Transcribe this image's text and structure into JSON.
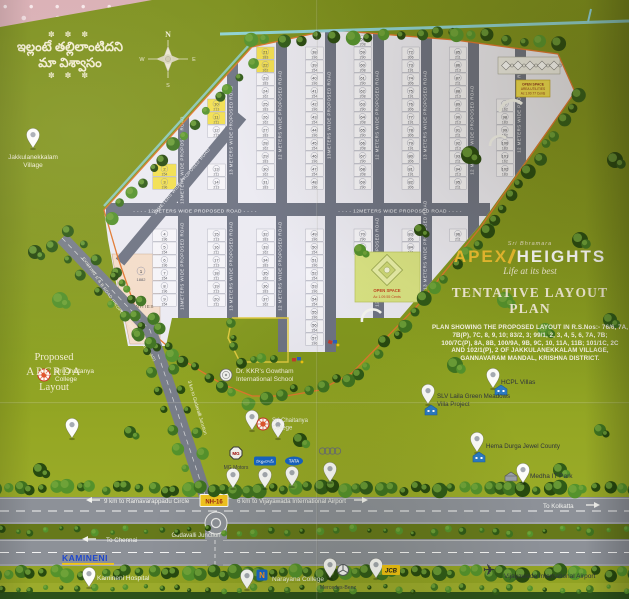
{
  "slogan": {
    "ornament": "✽ ✽ ✽",
    "line1": "ఇల్లంటే తల్లిలాంటిదని",
    "line2": "మా విశ్వాసం"
  },
  "village": {
    "label_line1": "Jakkulanekkalam",
    "label_line2": "Village"
  },
  "branding": {
    "pre_title": "Sri Bhramara",
    "brand_accent": "APEX",
    "brand_rest": "HEIGHTS",
    "tagline": "Life at its best",
    "plan_title": "TENTATIVE LAYOUT PLAN",
    "description_lines": [
      "PLAN SHOWING THE PROPOSED LAYOUT IN R.S.Nos:- 76/6, 7A,",
      "7B(P), 7C, 8, 9, 10; 83/2, 3; 99/1, 2, 3, 4, 5, 6, 7A, 7B;",
      "100/7C(P), 8A, 8B, 100/9A, 9B, 9C, 10, 11A, 11B; 101/1C, 2C",
      "AND 102/1(P), 2 OF JAKKULANEKKALAM VILLAGE,",
      "GANNAVARAM MANDAL, KRISHNA DISTRICT."
    ]
  },
  "apcrda": {
    "line1": "Proposed",
    "line2": "APCRDA",
    "line3": "Layout"
  },
  "compass": {
    "n": "N",
    "e": "E",
    "s": "S",
    "w": "W"
  },
  "estate": {
    "amenities_label": "AMENITIES",
    "amenity_plot": {
      "no": "1",
      "area": "1882"
    },
    "open_space_center": {
      "line1": "OPEN SPACE",
      "line2": "Ac 1.09.55 Cents"
    },
    "open_space_topright": {
      "line1": "OPEN SPACE",
      "line2": "AREA UTILITIES",
      "line3": "Ac 1.00.77 Cents"
    },
    "plot_areas": [
      "183",
      "196",
      "290",
      "306",
      "211",
      "162",
      "154",
      "208",
      "191",
      "213"
    ],
    "roads": {
      "vertical_label_13": "13 METERS WIDE PROPOSED ROAD",
      "vertical_label_13b": "13METERS WIDE PROPOSED ROAD",
      "vertical_label_12": "12 METERS WIDE PROPOSED ROAD",
      "horizontal_label": "- - - - 12METERS WIDE PROPOSED ROAD - - - -",
      "diagonal_label": "13METERS WIDE PROPOSED ROAD",
      "existing_label": "EXISTING R & B ROAD (PROPOSED 80FEET WIDE ROAD)",
      "gudavalli_label": "3 km to Gudavalli Junction"
    },
    "colors": {
      "plot": "#f5f4f8",
      "plot_highlight": "#f2df4e",
      "road": "#6e7383",
      "boundary": "#e0762e",
      "amenities": "#f4dcc9"
    }
  },
  "highway": {
    "ramavarappadu": "9 km to Ramavarappadu Circle",
    "nh16": "NH-16",
    "airport_6km": "6 km to Vijayawada International Airport",
    "to_kolkatta": "To Kolkatta",
    "to_chennai": "To Chennai",
    "junction": "Gudavalli Junction"
  },
  "logos": {
    "mg_text": "MG",
    "tata_text": "TATA",
    "jcb_text": "JCB",
    "narayana_letter": "N",
    "kamineni_text": "KAMINENI",
    "hyundai_text": "హ్యుందాయ్",
    "audi_text": "Audi"
  },
  "landmarks": [
    {
      "id": "jakkulanekkalam-village",
      "lines": [
        "Jakkulanekkalam",
        "Village"
      ],
      "logo": null,
      "pin": [
        33,
        148
      ],
      "text": [
        33,
        159
      ],
      "anchor": "middle",
      "color": "#f3efda",
      "size": 6.5
    },
    {
      "id": "sri-chaitanya-college-west",
      "lines": [
        "Sri Chaitanya",
        "College"
      ],
      "logo": "chaitanya",
      "logo_pos": [
        44,
        375
      ],
      "pin": [
        72,
        438
      ],
      "text": [
        55,
        373
      ],
      "anchor": "start",
      "color": "#f3efda",
      "size": 6.5
    },
    {
      "id": "gowtham-international-school",
      "lines": [
        "Dr. KKR's Gowtham",
        "International School"
      ],
      "logo": "school",
      "logo_pos": [
        226,
        375
      ],
      "pin": [
        278,
        438
      ],
      "text": [
        236,
        373
      ],
      "anchor": "start",
      "color": "#f3efda",
      "size": 6.5
    },
    {
      "id": "sri-chaitanya-college-center",
      "lines": [
        "Sri Chaitanya",
        "College"
      ],
      "logo": "chaitanya",
      "logo_pos": [
        263,
        424
      ],
      "pin": [
        252,
        430
      ],
      "text": [
        272,
        422
      ],
      "anchor": "start",
      "color": "#eef0e4",
      "size": 6
    },
    {
      "id": "mg-motors",
      "lines": [
        "MG Motors"
      ],
      "logo": "mg",
      "logo_pos": [
        236,
        453
      ],
      "pin": [
        233,
        488
      ],
      "text": [
        236,
        469
      ],
      "anchor": "middle",
      "color": "#3d4146",
      "size": 5
    },
    {
      "id": "hyundai-showroom",
      "lines": [],
      "logo": "hyundai",
      "logo_pos": [
        265,
        461
      ],
      "pin": [
        265,
        488
      ],
      "text": [
        265,
        473
      ],
      "anchor": "middle",
      "color": "#3d4146",
      "size": 5
    },
    {
      "id": "tata-showroom",
      "lines": [],
      "logo": "tata",
      "logo_pos": [
        294,
        461
      ],
      "pin": [
        292,
        486
      ],
      "text": [
        294,
        473
      ],
      "anchor": "middle",
      "color": "#3d4146",
      "size": 5
    },
    {
      "id": "audi-showroom",
      "lines": [],
      "logo": "audi",
      "logo_pos": [
        330,
        451
      ],
      "pin": [
        330,
        482
      ],
      "text": [
        330,
        463
      ],
      "anchor": "middle",
      "color": "#c0252c",
      "size": 6
    },
    {
      "id": "hcpl-villas",
      "lines": [
        "HCPL Villas"
      ],
      "logo": "building",
      "logo_pos": [
        501,
        395
      ],
      "pin": [
        493,
        388
      ],
      "text": [
        501,
        384
      ],
      "anchor": "start",
      "color": "#30353c",
      "size": 6.5
    },
    {
      "id": "slv-laila-green-meadows",
      "lines": [
        "SLV Laila Green Meadows",
        "Villa Project"
      ],
      "logo": "building",
      "logo_pos": [
        431,
        415
      ],
      "pin": [
        428,
        404
      ],
      "text": [
        437,
        398
      ],
      "anchor": "start",
      "color": "#30353c",
      "size": 6.2
    },
    {
      "id": "hema-durga-jewel-county",
      "lines": [
        "Hema Durga Jewel County"
      ],
      "logo": "building",
      "logo_pos": [
        479,
        462
      ],
      "pin": [
        477,
        452
      ],
      "text": [
        486,
        448
      ],
      "anchor": "start",
      "color": "#30353c",
      "size": 6.2
    },
    {
      "id": "medha-it-park",
      "lines": [
        "Medha IT Park"
      ],
      "logo": "hut",
      "logo_pos": [
        511,
        481
      ],
      "pin": [
        523,
        483
      ],
      "text": [
        530,
        478
      ],
      "anchor": "start",
      "color": "#30353c",
      "size": 6.5
    },
    {
      "id": "narayana-college",
      "lines": [
        "Narayana College"
      ],
      "logo": "narayana",
      "logo_pos": [
        262,
        575
      ],
      "pin": [
        247,
        589
      ],
      "text": [
        272,
        581
      ],
      "anchor": "start",
      "color": "#eef0e4",
      "size": 6.5
    },
    {
      "id": "mercedes-benz",
      "lines": [
        "Mercedes-Benz"
      ],
      "logo": "mercedes",
      "logo_pos": [
        343,
        570
      ],
      "pin": [
        330,
        578
      ],
      "text": [
        338,
        589
      ],
      "anchor": "middle",
      "color": "#3d4146",
      "size": 5.2
    },
    {
      "id": "jcb-showroom",
      "lines": [],
      "logo": "jcb",
      "logo_pos": [
        391,
        570
      ],
      "pin": [
        376,
        578
      ],
      "text": [
        391,
        584
      ],
      "anchor": "middle",
      "color": "#3d4146",
      "size": 5
    },
    {
      "id": "vijayawada-international-airport",
      "lines": [
        "Vijayawada International Airport"
      ],
      "logo": "plane",
      "logo_pos": [
        489,
        575
      ],
      "pin": null,
      "text": [
        504,
        578
      ],
      "anchor": "start",
      "color": "#30353c",
      "size": 6.5
    },
    {
      "id": "kamineni-hospital",
      "lines": [
        "Kamineni Hospital"
      ],
      "logo": "kamineni",
      "logo_pos": [
        62,
        561
      ],
      "pin": [
        89,
        587
      ],
      "text": [
        97,
        580
      ],
      "anchor": "start",
      "color": "#eef0e4",
      "size": 6.5
    }
  ]
}
